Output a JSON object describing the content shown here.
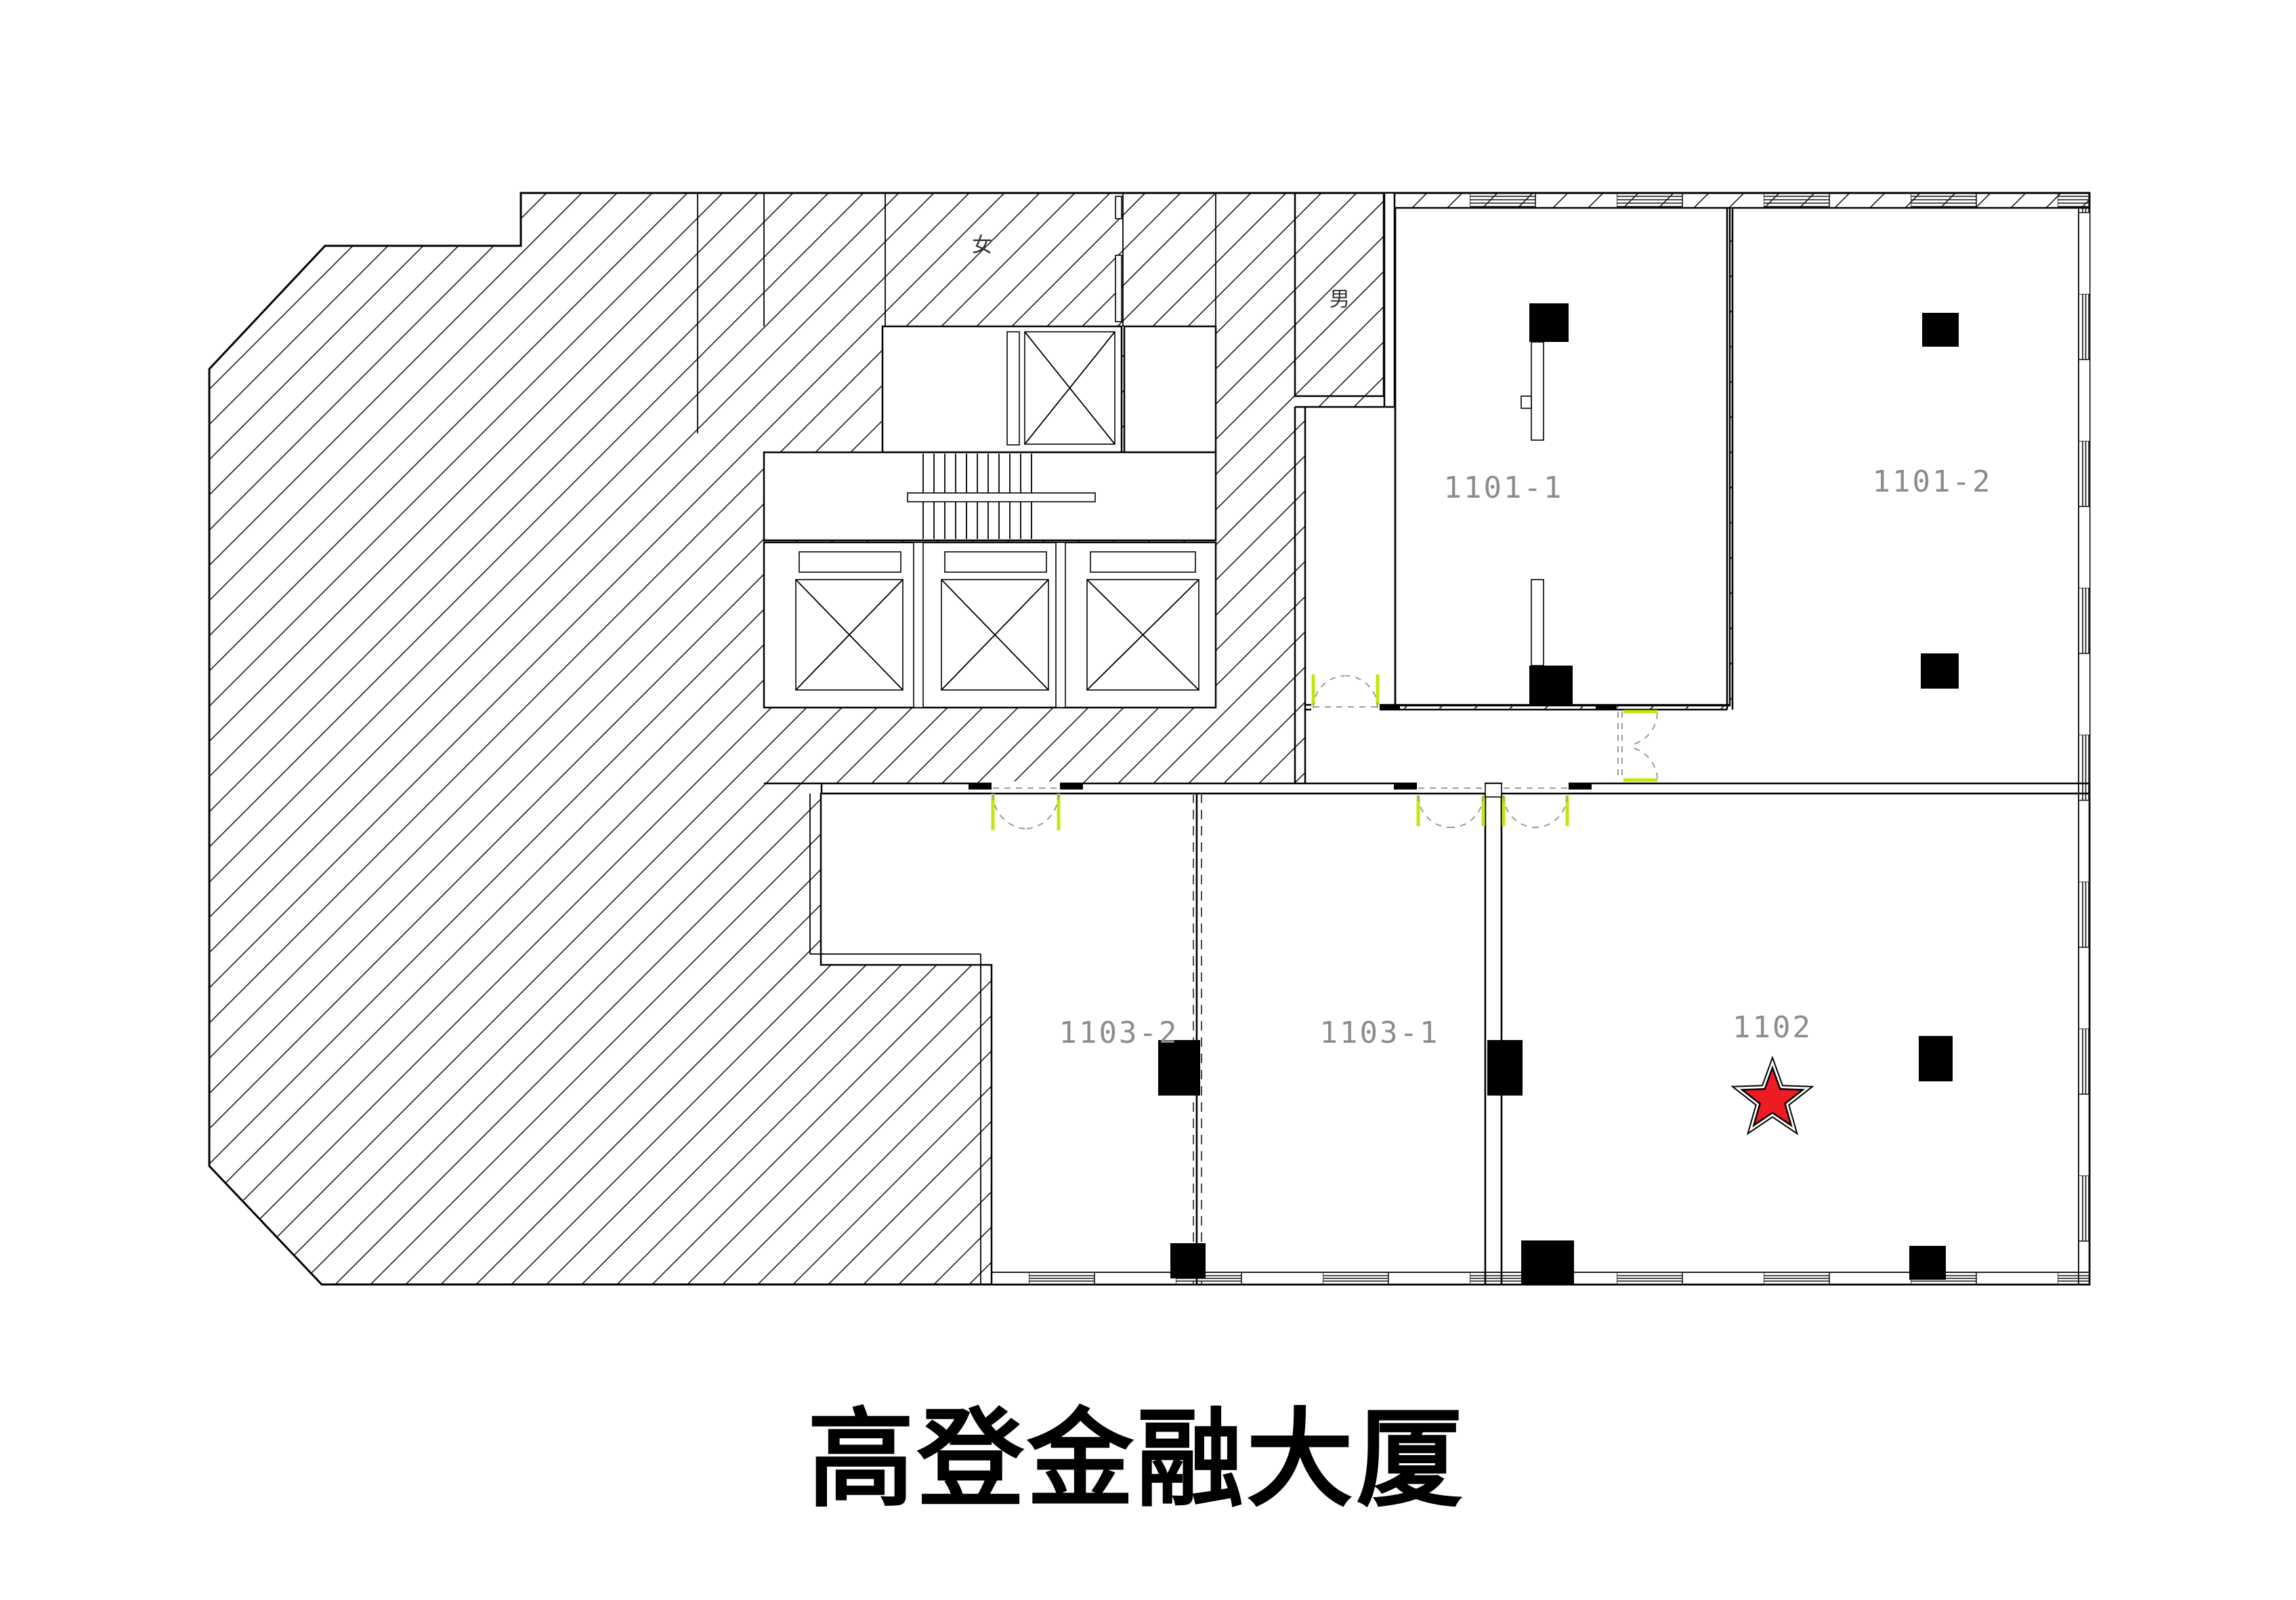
{
  "title": "高登金融大厦",
  "rooms": {
    "r1101_1": {
      "label": "1101-1"
    },
    "r1101_2": {
      "label": "1101-2"
    },
    "r1102": {
      "label": "1102"
    },
    "r1103_1": {
      "label": "1103-1"
    },
    "r1103_2": {
      "label": "1103-2"
    }
  },
  "facilities": {
    "female_wc": "女",
    "male_wc": "男"
  },
  "marker": {
    "type": "star",
    "marks_room": "1102",
    "color": "#ed1c24"
  },
  "colors": {
    "door_accent": "#c6e50b",
    "label_gray": "#8c8c8c",
    "swing_dash": "#9a9a9a",
    "line": "#000000"
  }
}
